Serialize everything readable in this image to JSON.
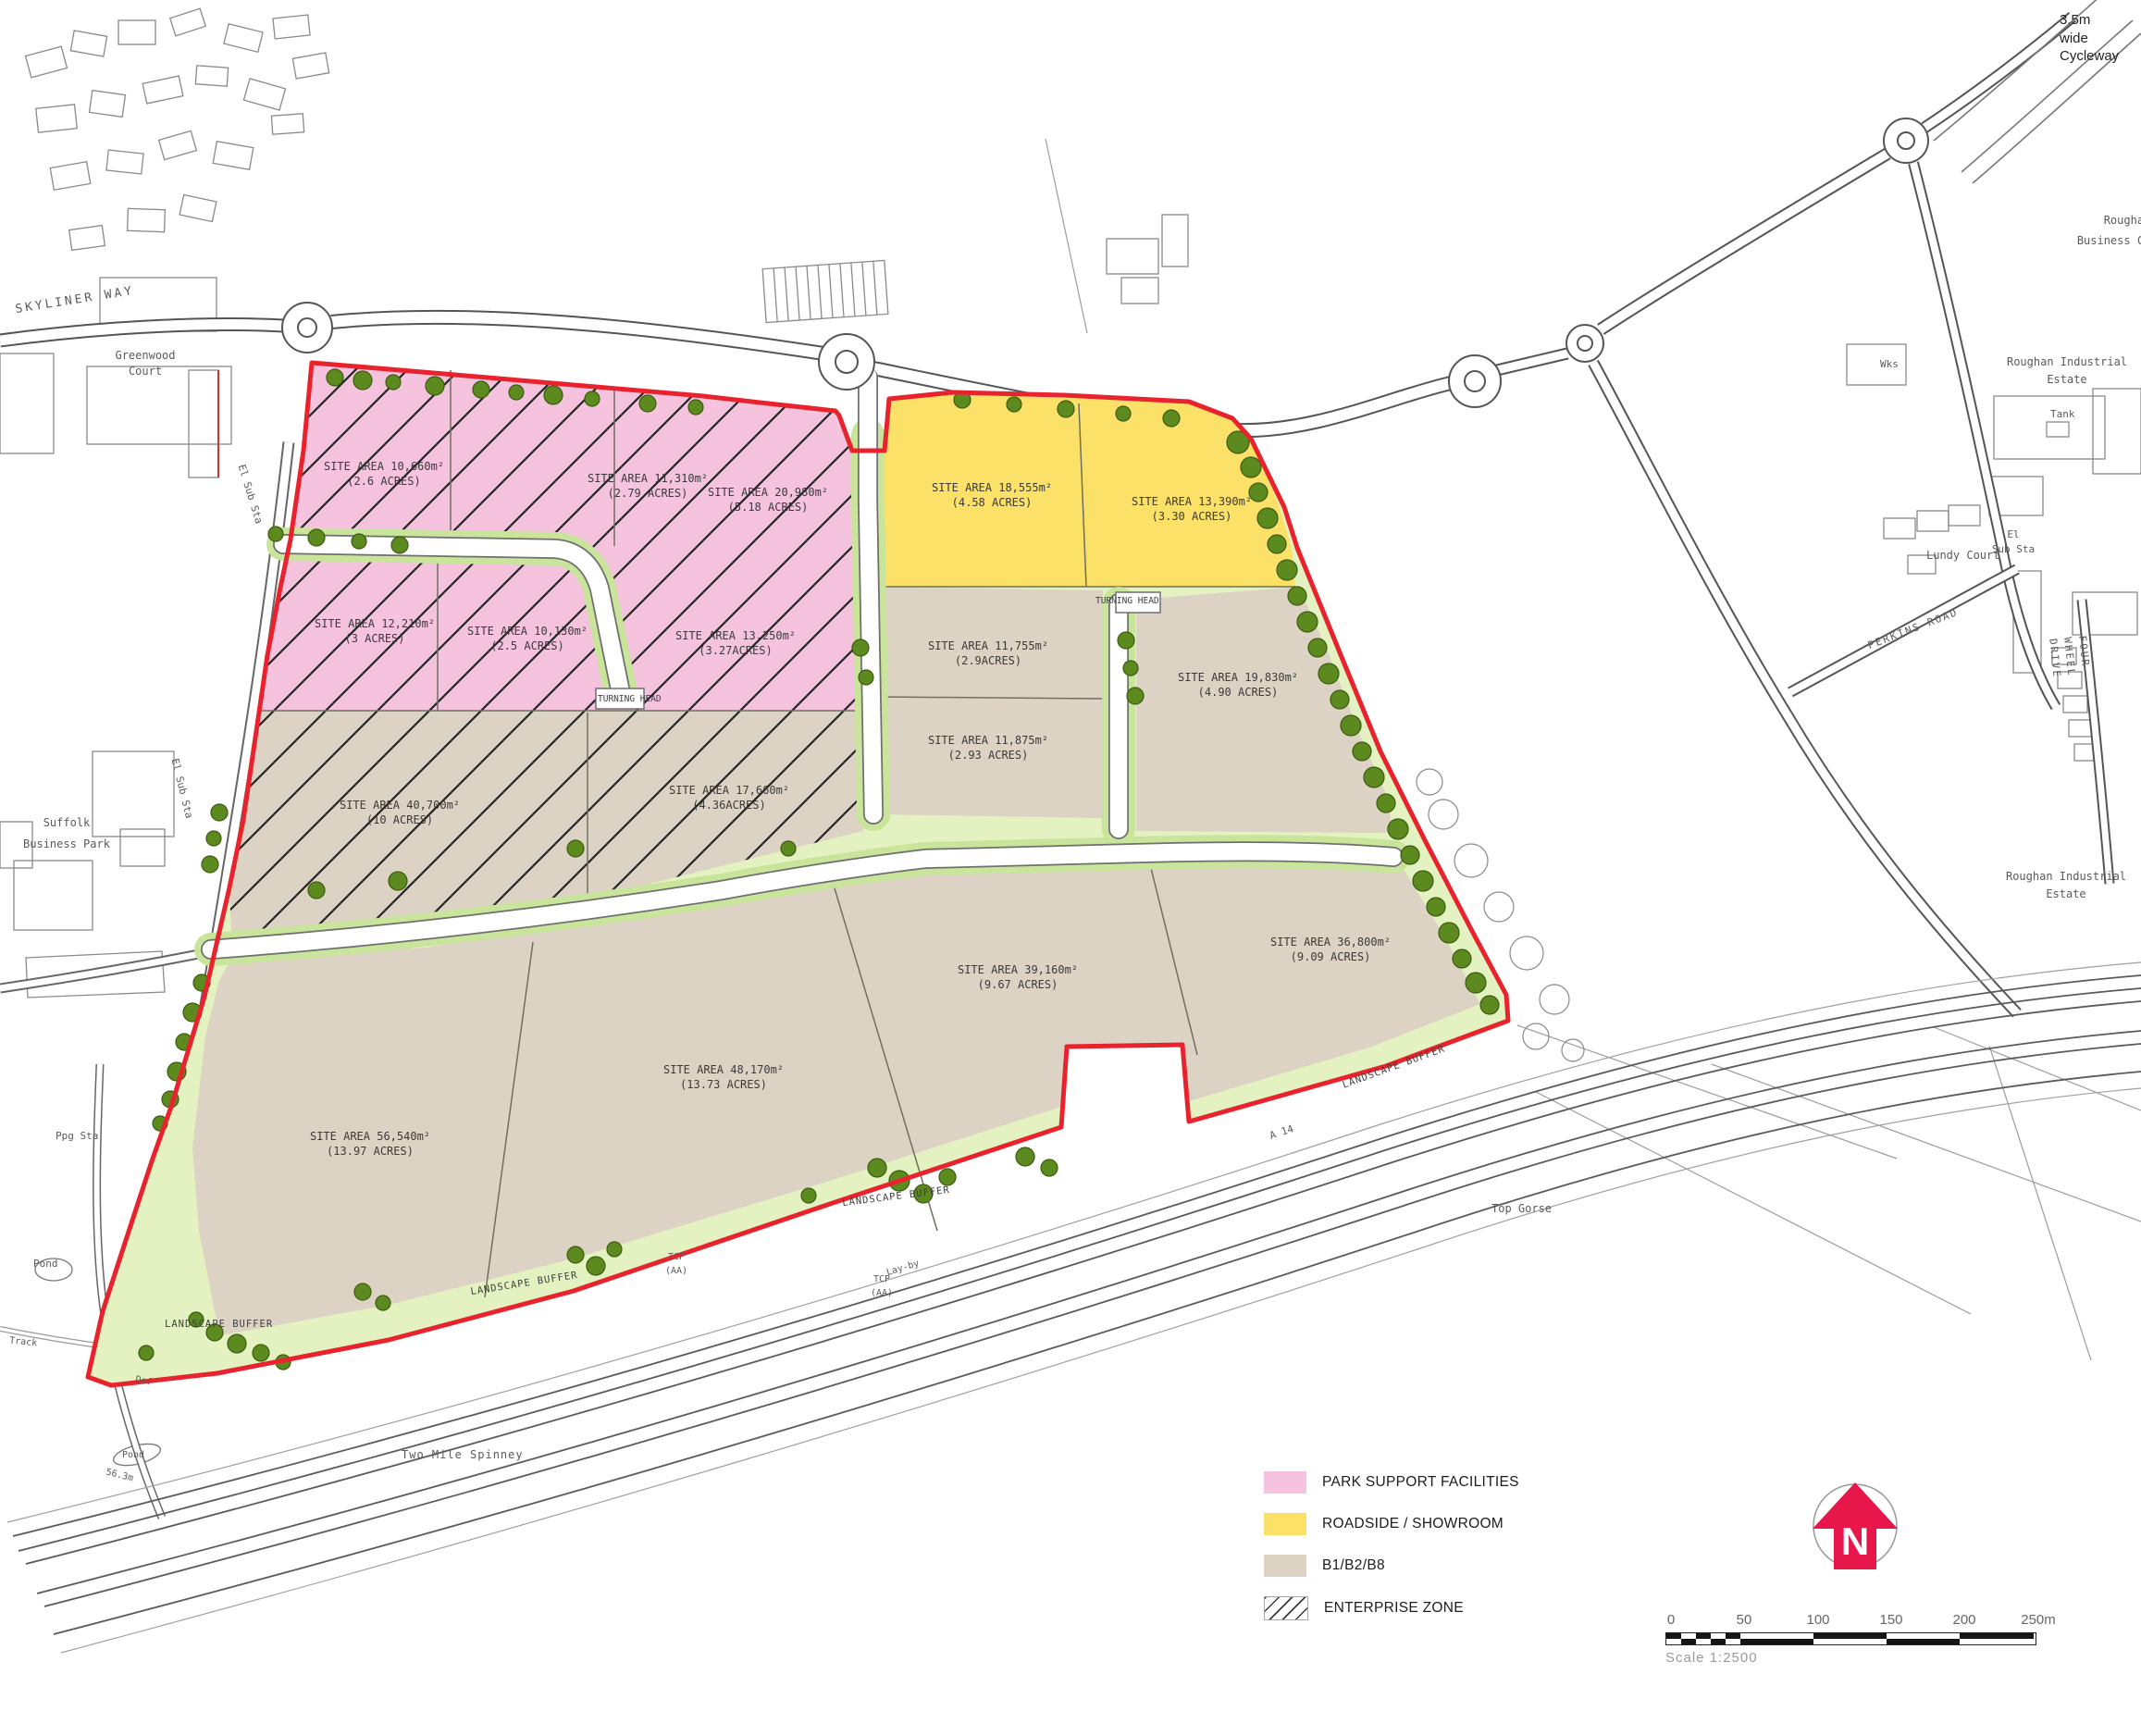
{
  "legend": {
    "items": [
      {
        "label": "PARK SUPPORT FACILITIES",
        "color": "#f6c3df"
      },
      {
        "label": "ROADSIDE / SHOWROOM",
        "color": "#fce169"
      },
      {
        "label": "B1/B2/B8",
        "color": "#ddd3c4"
      },
      {
        "label": "ENTERPRISE ZONE",
        "color": "hatched"
      }
    ]
  },
  "north_arrow": {
    "label": "N",
    "color": "#e8174b"
  },
  "scale_bar": {
    "ticks": [
      "0",
      "50",
      "100",
      "150",
      "200",
      "250m"
    ],
    "caption": "Scale  1:2500"
  },
  "site": {
    "boundary_color": "#e8232d",
    "buffer_color": "#e3f2c0"
  },
  "parcels": [
    {
      "area": "SITE AREA 10,660m²",
      "acres": "(2.6 ACRES)"
    },
    {
      "area": "SITE AREA 11,310m²",
      "acres": "(2.79 ACRES)"
    },
    {
      "area": "SITE AREA 20,980m²",
      "acres": "(5.18 ACRES)"
    },
    {
      "area": "SITE AREA 12,210m²",
      "acres": "(3 ACRES)"
    },
    {
      "area": "SITE AREA 10,130m²",
      "acres": "(2.5 ACRES)"
    },
    {
      "area": "SITE AREA 13,250m²",
      "acres": "(3.27ACRES)"
    },
    {
      "area": "SITE AREA 18,555m²",
      "acres": "(4.58 ACRES)"
    },
    {
      "area": "SITE AREA 13,390m²",
      "acres": "(3.30 ACRES)"
    },
    {
      "area": "SITE AREA 11,755m²",
      "acres": "(2.9ACRES)"
    },
    {
      "area": "SITE AREA 11,875m²",
      "acres": "(2.93 ACRES)"
    },
    {
      "area": "SITE AREA 19,830m²",
      "acres": "(4.90 ACRES)"
    },
    {
      "area": "SITE AREA 40,700m²",
      "acres": "(10 ACRES)"
    },
    {
      "area": "SITE AREA 17,660m²",
      "acres": "(4.36ACRES)"
    },
    {
      "area": "SITE AREA 39,160m²",
      "acres": "(9.67 ACRES)"
    },
    {
      "area": "SITE AREA 36,800m²",
      "acres": "(9.09 ACRES)"
    },
    {
      "area": "SITE AREA 48,170m²",
      "acres": "(13.73 ACRES)"
    },
    {
      "area": "SITE AREA 56,540m²",
      "acres": "(13.97 ACRES)"
    }
  ],
  "labels": {
    "cycleway": "3.5m\nwide\nCycleway",
    "skyliner_way": "SKYLINER WAY",
    "greenwood_court": "Greenwood\nCourt",
    "el_sub_sta_a": "El Sub Sta",
    "el_sub_sta_b": "El Sub Sta",
    "el_sub_sta_c": "El\nSub Sta",
    "suffolk_business_park": "Suffolk\nBusiness Park",
    "roughan_business_centre": "Roughan\nBusiness Centre",
    "roughan_industrial_estate_north": "Roughan Industrial\nEstate",
    "roughan_industrial_estate_south": "Roughan Industrial\nEstate",
    "tank": "Tank",
    "wks": "Wks",
    "lundy_court": "Lundy Court",
    "perkins_road": "PERKINS ROAD",
    "four_wheel_drive": "FOUR WHEEL DRIVE",
    "top_gorse": "Top Gorse",
    "two_mile_spinney": "Two Mile Spinney",
    "pond_a": "Pond",
    "pond_b": "Pond",
    "ppg_sta": "Ppg Sta",
    "def": "Def",
    "track": "Track",
    "spot_height": "56.3m",
    "a14": "A 14",
    "lay_by": "Lay-by",
    "tcp_aa_a": "TCP\n(AA)",
    "tcp_aa_b": "TCP\n(AA)",
    "turning_head_a": "TURNING HEAD",
    "turning_head_b": "TURNING HEAD",
    "landscape_buffer_a": "LANDSCAPE BUFFER",
    "landscape_buffer_b": "LANDSCAPE BUFFER",
    "landscape_buffer_c": "LANDSCAPE BUFFER",
    "landscape_buffer_d": "LANDSCAPE BUFFER"
  }
}
